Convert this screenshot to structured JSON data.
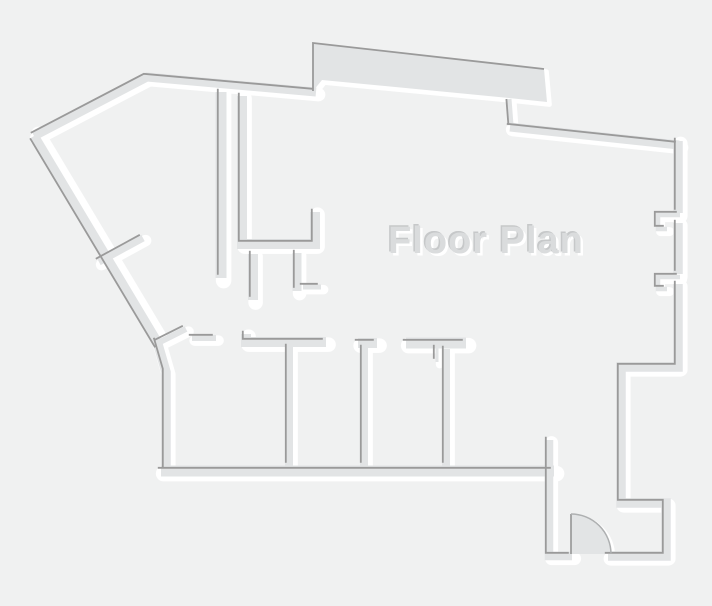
{
  "title": "Floor Plan",
  "canvas": {
    "width": 712,
    "height": 606
  },
  "colors": {
    "background": "#f0f1f1",
    "wall_fill": "#e2e4e5",
    "wall_edge": "#9a9a9a",
    "wall_highlight": "#ffffff",
    "door_edge": "#aeb0b1",
    "title_color": "#dadcdd",
    "title_edge": "#c6c8c9",
    "title_shadow": "#ffffff"
  },
  "defaults": {
    "dark_offset": [
      -3.2,
      -3.2
    ],
    "white_offset": [
      2.6,
      2.6
    ],
    "dark_width": 1.8,
    "white_extra": 4.5
  },
  "walls": [
    {
      "id": "outer-top-left",
      "pts": [
        [
          34,
          136
        ],
        [
          147,
          77
        ],
        [
          316,
          92
        ]
      ],
      "w": 9
    },
    {
      "id": "outer-left-diagonal",
      "pts": [
        [
          34,
          136
        ],
        [
          159,
          345
        ]
      ],
      "w": 9.5,
      "dk": [
        -3.9,
        2.3
      ],
      "wt": [
        4.2,
        -2.4
      ]
    },
    {
      "id": "outer-left-lower",
      "pts": [
        [
          157,
          341
        ],
        [
          166,
          372
        ],
        [
          166,
          471
        ]
      ],
      "w": 9.5
    },
    {
      "id": "top-connector",
      "pts": [
        [
          509,
          99
        ],
        [
          511,
          125
        ]
      ],
      "w": 5,
      "dk": [
        -2.6,
        0
      ],
      "wt": [
        2.6,
        0
      ]
    },
    {
      "id": "outer-top-right",
      "pts": [
        [
          510,
          127
        ],
        [
          679,
          145
        ]
      ],
      "w": 9
    },
    {
      "id": "outer-right-upper",
      "pts": [
        [
          678,
          141
        ],
        [
          678,
          213
        ]
      ],
      "w": 9.5
    },
    {
      "id": "right-jamb-upper",
      "pts": [
        [
          680,
          215
        ],
        [
          658,
          215
        ],
        [
          658,
          229
        ],
        [
          667,
          229
        ]
      ],
      "w": 4.5
    },
    {
      "id": "outer-right-mid",
      "pts": [
        [
          678,
          223
        ],
        [
          678,
          274
        ]
      ],
      "w": 9.5
    },
    {
      "id": "right-jamb-lower",
      "pts": [
        [
          680,
          277
        ],
        [
          658,
          277
        ],
        [
          658,
          289
        ],
        [
          667,
          289
        ]
      ],
      "w": 4.5
    },
    {
      "id": "outer-right-lower",
      "pts": [
        [
          678,
          284
        ],
        [
          678,
          367
        ],
        [
          621,
          367
        ],
        [
          621,
          503
        ],
        [
          666,
          503
        ],
        [
          666,
          556
        ],
        [
          608,
          556
        ]
      ],
      "w": 9.5
    },
    {
      "id": "entry-wall",
      "pts": [
        [
          549,
          440
        ],
        [
          549,
          556
        ],
        [
          572,
          556
        ]
      ],
      "w": 8.5
    },
    {
      "id": "rooms-bottom-wall",
      "pts": [
        [
          161,
          471
        ],
        [
          554,
          471
        ]
      ],
      "w": 11
    },
    {
      "id": "hall-stub",
      "pts": [
        [
          192,
          338
        ],
        [
          216,
          338
        ]
      ],
      "w": 6
    },
    {
      "id": "fork-stub",
      "pts": [
        [
          158,
          343
        ],
        [
          186,
          329
        ]
      ],
      "w": 6
    },
    {
      "id": "diag-stub",
      "pts": [
        [
          99,
          262
        ],
        [
          143,
          238
        ]
      ],
      "w": 7
    },
    {
      "id": "room1-top",
      "pts": [
        [
          246,
          334
        ],
        [
          246,
          342
        ],
        [
          326,
          342
        ]
      ],
      "w": 10
    },
    {
      "id": "room1-divider",
      "pts": [
        [
          289,
          347
        ],
        [
          289,
          466
        ]
      ],
      "w": 8
    },
    {
      "id": "room2-top",
      "pts": [
        [
          358,
          343
        ],
        [
          377,
          343
        ]
      ],
      "w": 10
    },
    {
      "id": "room2-divider",
      "pts": [
        [
          364,
          348
        ],
        [
          364,
          466
        ]
      ],
      "w": 8
    },
    {
      "id": "room3-top",
      "pts": [
        [
          406,
          343
        ],
        [
          466,
          343
        ]
      ],
      "w": 11
    },
    {
      "id": "room3-divider",
      "pts": [
        [
          446,
          349
        ],
        [
          446,
          466
        ]
      ],
      "w": 8
    },
    {
      "id": "room3-jamb",
      "pts": [
        [
          437,
          348
        ],
        [
          437,
          362
        ]
      ],
      "w": 3
    },
    {
      "id": "upper-wall-a",
      "pts": [
        [
          221,
          92
        ],
        [
          221,
          278
        ]
      ],
      "w": 11
    },
    {
      "id": "upper-wall-b",
      "pts": [
        [
          242,
          96
        ],
        [
          242,
          244
        ],
        [
          315,
          244
        ],
        [
          315,
          212
        ]
      ],
      "w": 10
    },
    {
      "id": "upper-stub-1",
      "pts": [
        [
          253,
          254
        ],
        [
          253,
          300
        ]
      ],
      "w": 10
    },
    {
      "id": "upper-stub-2",
      "pts": [
        [
          297,
          253
        ],
        [
          297,
          291
        ]
      ],
      "w": 9
    },
    {
      "id": "upper-stub-foot",
      "pts": [
        [
          303,
          287
        ],
        [
          321,
          287
        ]
      ],
      "w": 5
    }
  ],
  "protrusion": {
    "points": [
      [
        313,
        43
      ],
      [
        544,
        69
      ],
      [
        547,
        102
      ],
      [
        509,
        98
      ],
      [
        322,
        80
      ],
      [
        313,
        91
      ]
    ],
    "dark_edge": [
      [
        313,
        91
      ],
      [
        313,
        43
      ],
      [
        544,
        69
      ]
    ]
  },
  "door": {
    "cx": 571,
    "cy": 554,
    "r": 40
  }
}
